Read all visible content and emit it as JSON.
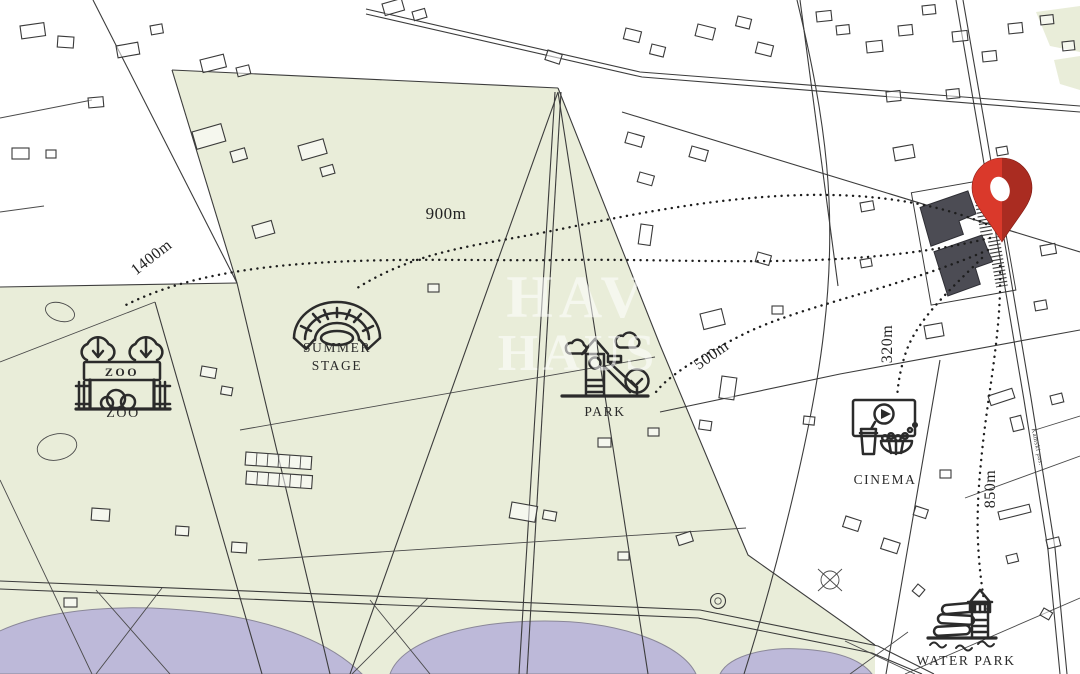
{
  "map": {
    "watermark": {
      "line1": "HAV",
      "line2": "HAUS"
    },
    "street_label": "Kamski pas.",
    "poi": {
      "zoo": {
        "label": "ZOO",
        "sign_text": "ZOO",
        "distance": "1400m"
      },
      "summer_stage": {
        "label_line1": "SUMMER",
        "label_line2": "STAGE",
        "distance": "900m"
      },
      "park": {
        "label": "PARK",
        "distance": "500m"
      },
      "cinema": {
        "label": "CINEMA",
        "distance": "320m"
      },
      "water_park": {
        "label": "WATER PARK",
        "distance": "850m"
      }
    },
    "colors": {
      "park_green": "#e9edd9",
      "lake_purple": "#bdb9d9",
      "pin_red": "#da392b",
      "building_dark": "#4c4c54",
      "line": "#3c3c3c"
    }
  }
}
